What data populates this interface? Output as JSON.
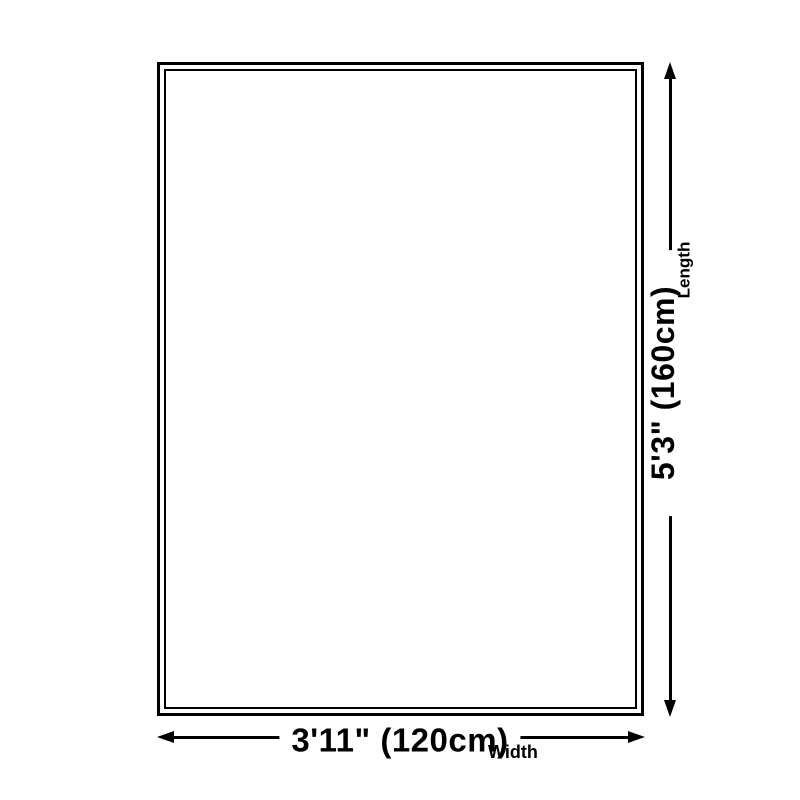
{
  "diagram": {
    "kind": "product-dimension-diagram",
    "width": {
      "value": "3'11\" (120cm)",
      "label": "Width"
    },
    "length": {
      "value": "5'3\" (160cm)",
      "label": "Length"
    },
    "colors": {
      "ink": "#000000",
      "background": "#ffffff"
    }
  }
}
